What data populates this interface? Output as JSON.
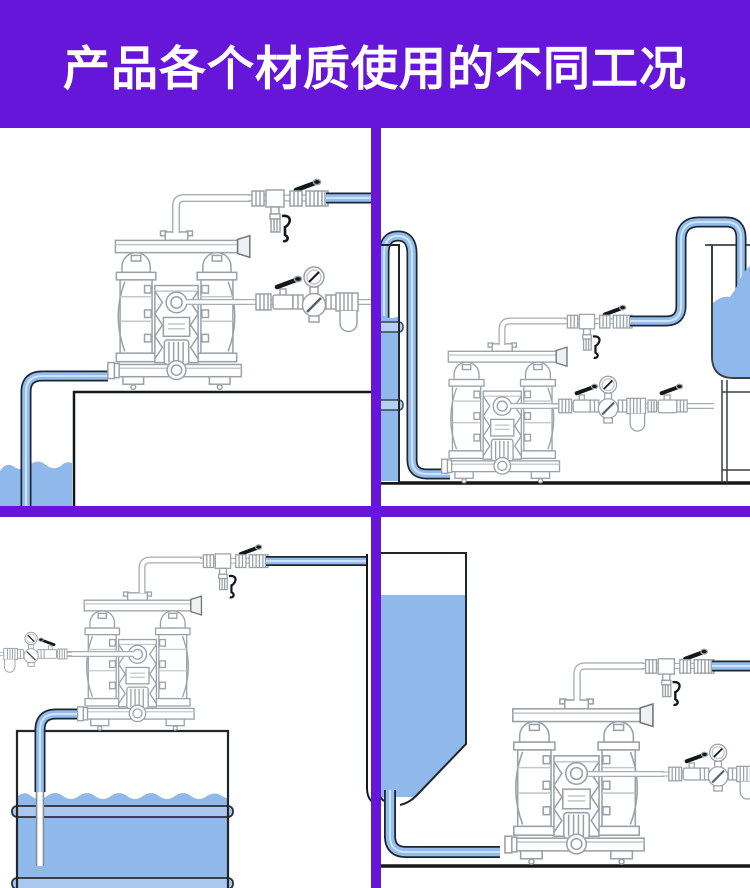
{
  "header": {
    "title": "产品各个材质使用的不同工况"
  },
  "theme": {
    "purple": "#6616d8",
    "pipe_blue": "#93bdec",
    "pipe_highlight": "#d6e7f8",
    "pipe_outline": "#1c2733",
    "liquid_blue": "#8fb9ea",
    "band_blue": "#b5d0f1",
    "outline_black": "#15181b",
    "drawing_gray": "#9aa2a8",
    "white": "#ffffff"
  },
  "panels": [
    {
      "id": "top-left",
      "name": "pump-on-tank-suction-from-pit"
    },
    {
      "id": "top-right",
      "name": "floor-pump-drum-to-elevated-tank"
    },
    {
      "id": "bottom-left",
      "name": "drum-top-mounted-pump"
    },
    {
      "id": "bottom-right",
      "name": "hopper-gravity-feed-pump"
    }
  ]
}
